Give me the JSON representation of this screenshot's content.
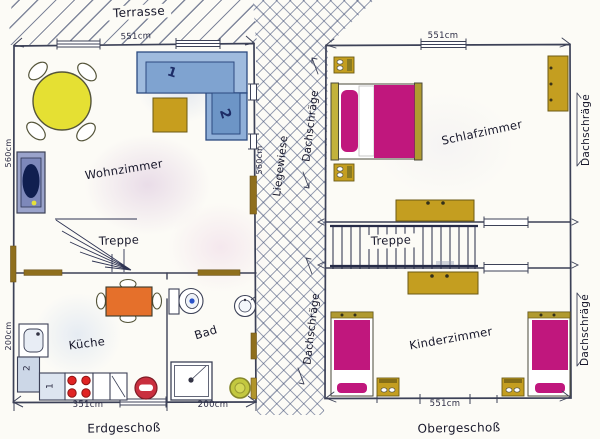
{
  "floors": {
    "ground_label": "Erdgeschoß",
    "upper_label": "Obergeschoß"
  },
  "areas": {
    "terrasse": "Terrasse",
    "liegewiese": "Liegewiese",
    "dachschraege": "Dachschräge"
  },
  "rooms": {
    "wohnzimmer": "Wohnzimmer",
    "treppe": "Treppe",
    "kueche": "Küche",
    "bad": "Bad",
    "schlafzimmer": "Schlafzimmer",
    "kinderzimmer": "Kinderzimmer"
  },
  "dimensions": {
    "eg_top": "551cm",
    "eg_left_height": "560cm",
    "eg_left_kitchen": "200cm",
    "eg_right_height": "560cm",
    "eg_bottom_kitchen": "351cm",
    "eg_bottom_bath": "200cm",
    "og_top": "551cm",
    "og_bottom": "551cm"
  },
  "furniture_numbers": {
    "sofa_1": "1",
    "sofa_2": "2",
    "counter_1": "1",
    "counter_2": "2"
  },
  "colors": {
    "ink": "#20233a",
    "beam_brown": "#8f6f1d",
    "furniture_gold": "#c49e20",
    "bed_magenta": "#c0177d",
    "sofa_blue": "#8fafd8",
    "table_yellow": "#e5e033",
    "table_orange": "#e5702b",
    "stove_red": "#e02424",
    "rug_olive": "#c3c83f"
  }
}
